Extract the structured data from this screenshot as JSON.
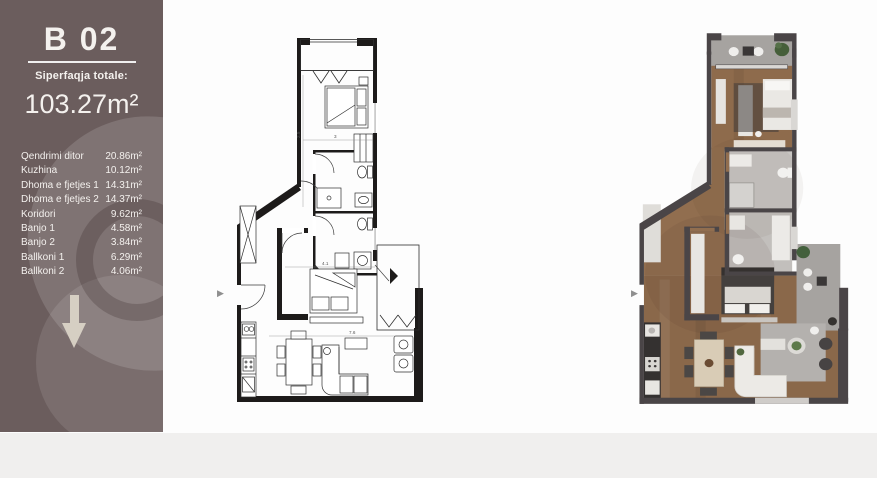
{
  "canvas": {
    "background": "#ffffff",
    "footer_band_color": "#f0efee"
  },
  "sidebar": {
    "title": "B 02",
    "subtitle": "Siperfaqja totale:",
    "total_area": "103.27m²",
    "rooms": [
      {
        "name": "Qendrimi ditor",
        "area": "20.86m²"
      },
      {
        "name": "Kuzhina",
        "area": "10.12m²"
      },
      {
        "name": "Dhoma e fjetjes 1",
        "area": "14.31m²"
      },
      {
        "name": "Dhoma e fjetjes 2",
        "area": "14.37m²"
      },
      {
        "name": "Koridori",
        "area": "9.62m²"
      },
      {
        "name": "Banjo 1",
        "area": "4.58m²"
      },
      {
        "name": "Banjo 2",
        "area": "3.84m²"
      },
      {
        "name": "Ballkoni 1",
        "area": "6.29m²"
      },
      {
        "name": "Ballkoni 2",
        "area": "4.06m²"
      }
    ],
    "colors": {
      "background": "#6b5d5d",
      "text": "#f4f1ee",
      "watermark_light": "#847473",
      "watermark_ring": "#5c4f4f",
      "arrow": "#ddd6c9"
    }
  },
  "plans": {
    "technical": {
      "dims": [
        "3",
        "2.5",
        "4.1",
        "7.6"
      ],
      "wall_color": "#1d1b1a"
    },
    "rendered": {
      "wall_color": "#4a4547",
      "wood_floor": "#8e6b4c",
      "tile_floor": "#c7c4c1",
      "balcony_floor": "#a6a3a0"
    }
  },
  "icons": {
    "entry_arrow": "▶",
    "down_arrow": "down-arrow"
  }
}
